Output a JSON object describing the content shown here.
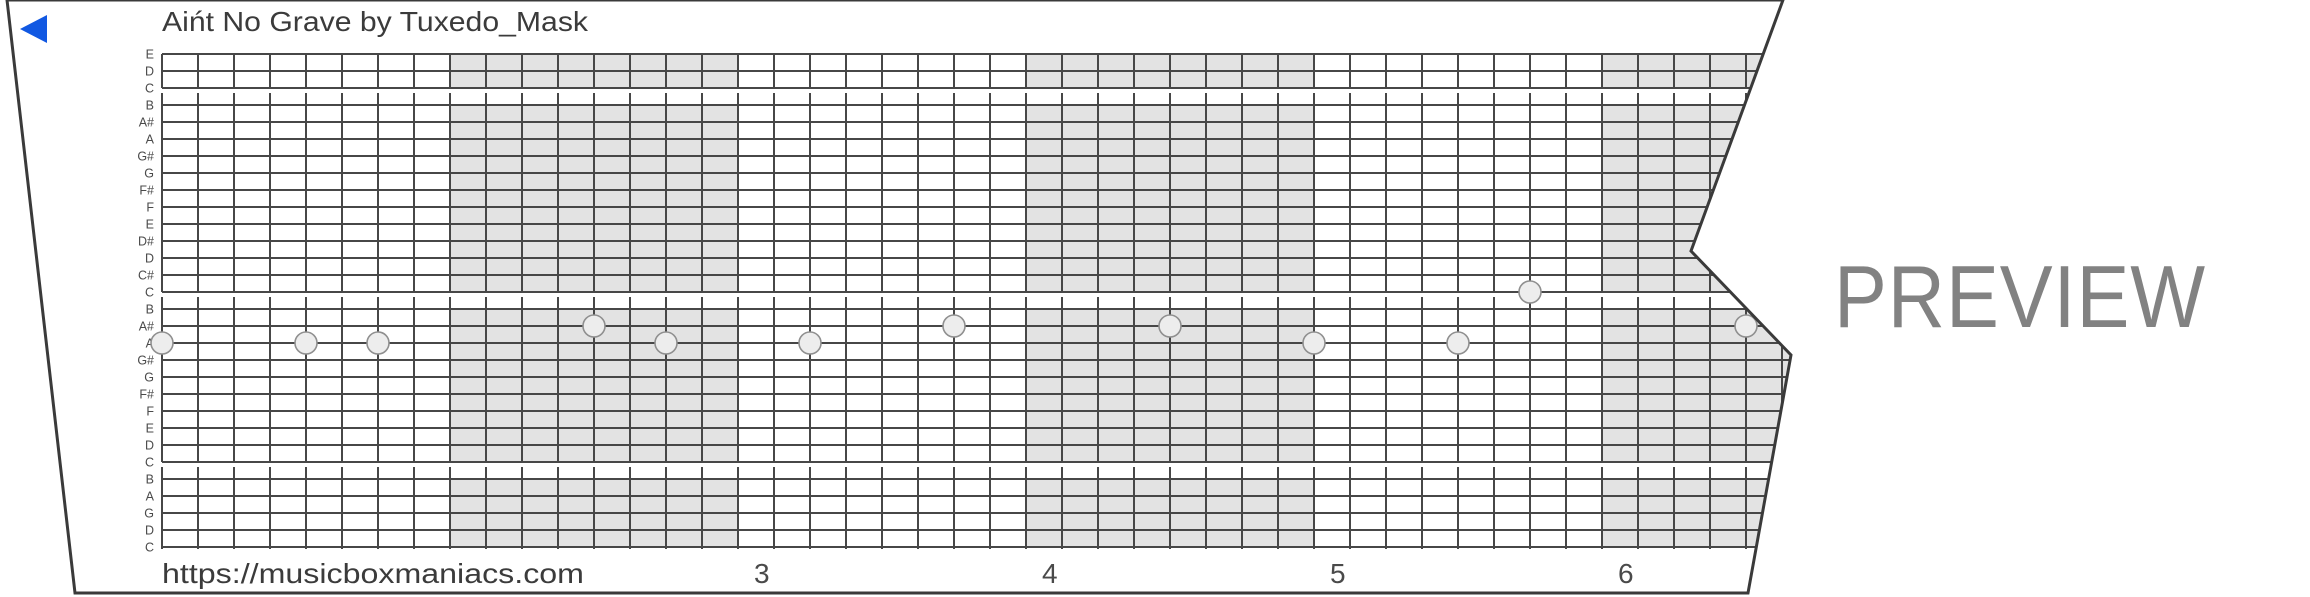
{
  "strip": {
    "title": "Aińt No Grave by Tuxedo_Mask",
    "url": "https://musicboxmaniacs.com",
    "watermark": "PREVIEW",
    "play_marker_color": "#1158e2",
    "note_labels": [
      "E",
      "D",
      "C",
      "B",
      "A#",
      "A",
      "G#",
      "G",
      "F#",
      "F",
      "E",
      "D#",
      "D",
      "C#",
      "C",
      "B",
      "A#",
      "A",
      "G#",
      "G",
      "F#",
      "F",
      "E",
      "D",
      "C",
      "B",
      "A",
      "G",
      "D",
      "C"
    ],
    "gap_after_rows": [
      2,
      14,
      24
    ],
    "shaded_measures": [
      2,
      4,
      6
    ],
    "steps_per_measure": 8,
    "measure_numbers": [
      {
        "label": "3",
        "start_step": 16
      },
      {
        "label": "4",
        "start_step": 24
      },
      {
        "label": "5",
        "start_step": 32
      },
      {
        "label": "6",
        "start_step": 40
      }
    ],
    "notes": [
      {
        "step": 0,
        "row": 17,
        "pitch": "A"
      },
      {
        "step": 4,
        "row": 17,
        "pitch": "A"
      },
      {
        "step": 6,
        "row": 17,
        "pitch": "A"
      },
      {
        "step": 12,
        "row": 16,
        "pitch": "A#"
      },
      {
        "step": 14,
        "row": 17,
        "pitch": "A"
      },
      {
        "step": 18,
        "row": 17,
        "pitch": "A"
      },
      {
        "step": 22,
        "row": 16,
        "pitch": "A#"
      },
      {
        "step": 28,
        "row": 16,
        "pitch": "A#"
      },
      {
        "step": 32,
        "row": 17,
        "pitch": "A"
      },
      {
        "step": 36,
        "row": 17,
        "pitch": "A"
      },
      {
        "step": 38,
        "row": 14,
        "pitch": "C"
      },
      {
        "step": 44,
        "row": 16,
        "pitch": "A#"
      }
    ],
    "colors": {
      "shading": "#e3e3e3",
      "grid_line": "#474747",
      "border": "#3a3a3a",
      "text": "#3b3b3b",
      "muted_text": "#4a4a4a",
      "watermark": "#828282",
      "note_fill": "#ededed",
      "note_stroke": "#8f8f8f",
      "paper": "#ffffff"
    }
  }
}
